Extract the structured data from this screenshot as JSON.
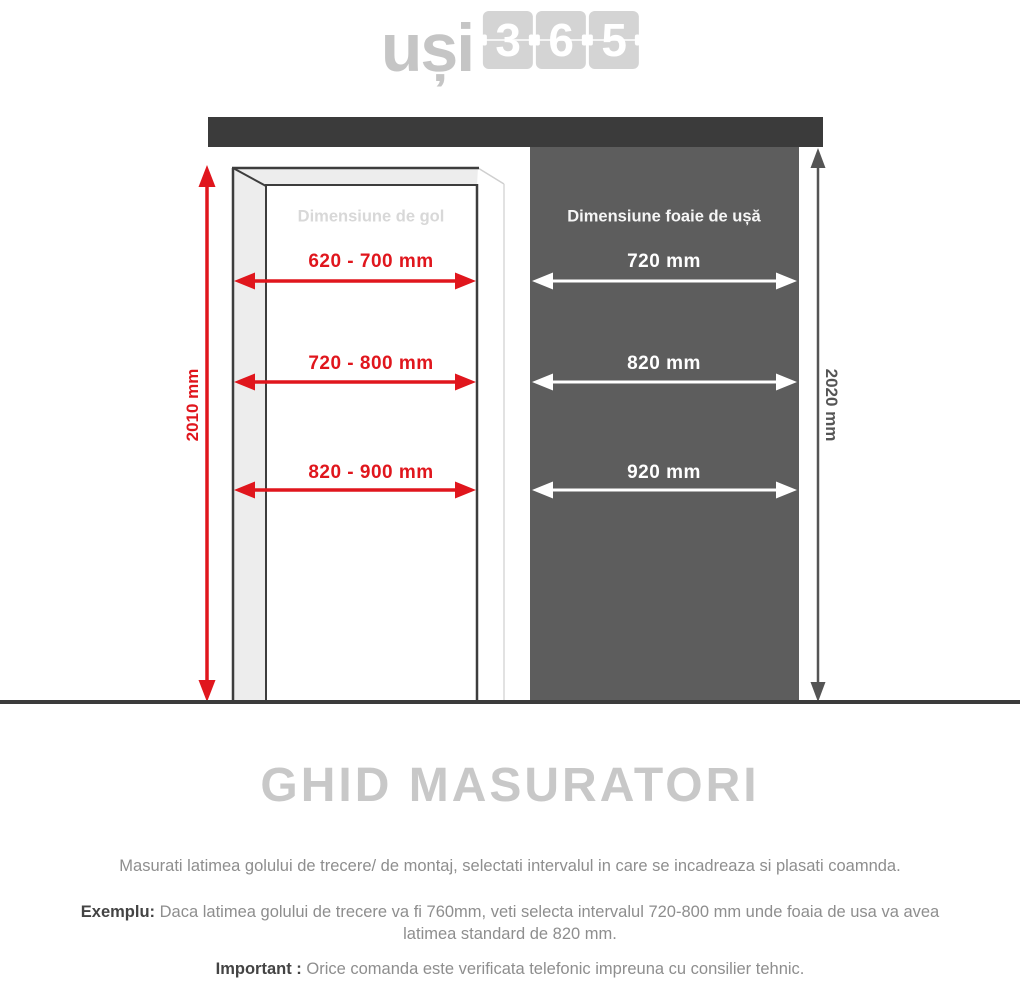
{
  "logo": {
    "text": "uși",
    "digits": [
      "3",
      "6",
      "5"
    ]
  },
  "diagram": {
    "gap": {
      "title": "Dimensiune de gol",
      "height_label": "2010 mm",
      "widths": [
        "620 - 700 mm",
        "720 - 800 mm",
        "820 - 900 mm"
      ]
    },
    "leaf": {
      "title": "Dimensiune foaie de ușă",
      "height_label": "2020 mm",
      "widths": [
        "720 mm",
        "820 mm",
        "920 mm"
      ]
    }
  },
  "colors": {
    "accent_red": "#e0161d",
    "wall_bar": "#3b3b3b",
    "door_leaf_panel": "#5d5d5d",
    "frame_fill": "#ededed",
    "title_gray": "#c8c8c8",
    "body_gray": "#8e8e8e"
  },
  "content": {
    "title": "GHID MASURATORI",
    "intro": "Masurati latimea golului de trecere/ de montaj, selectati intervalul in care se incadreaza si plasati coamnda.",
    "example_label": "Exemplu:",
    "example_text": "Daca latimea golului de trecere va fi 760mm, veti selecta intervalul 720-800 mm unde foaia de usa va avea latimea standard de 820 mm.",
    "important_label": "Important :",
    "important_text": "Orice comanda este verificata telefonic impreuna cu consilier tehnic."
  }
}
